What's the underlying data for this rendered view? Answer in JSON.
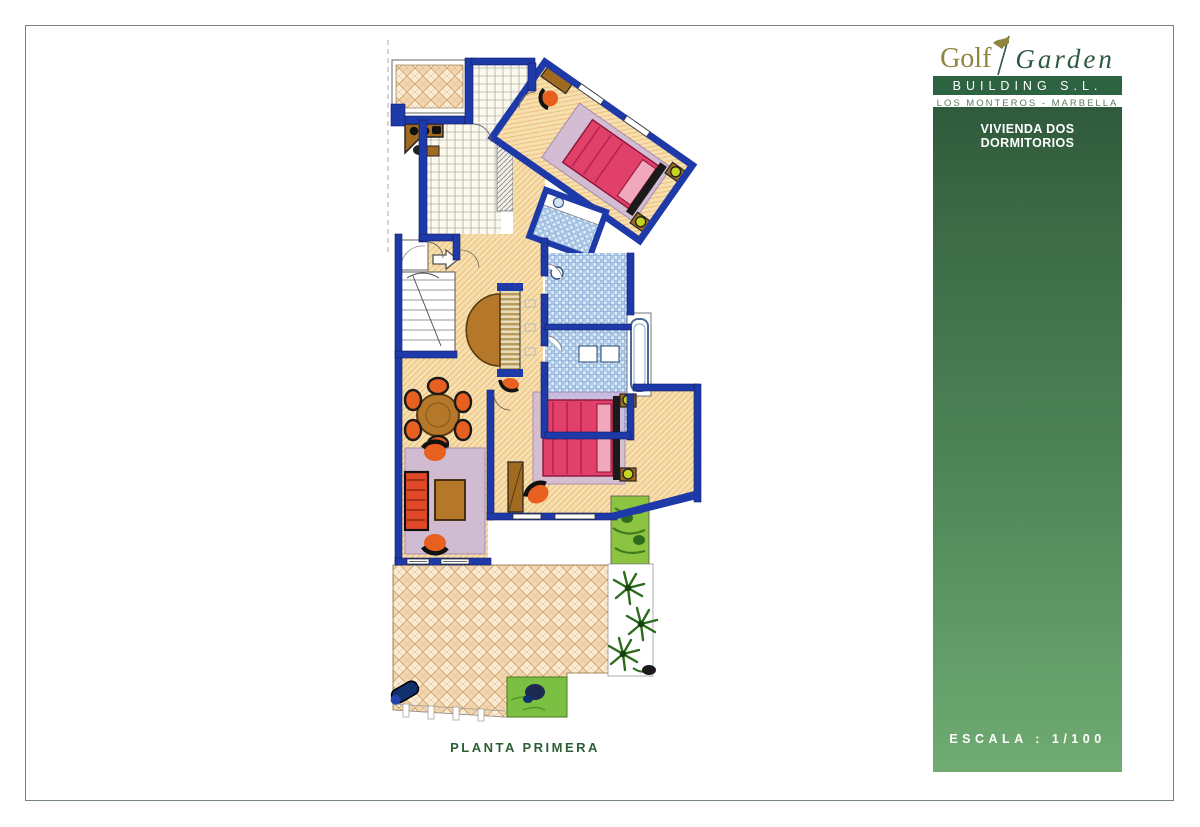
{
  "page": {
    "title": "Golf Garden Building S.L. - Vivienda Dos Dormitorios"
  },
  "brand": {
    "logo_word1": "Golf",
    "logo_word2": "Garden",
    "tagline_bar": "BUILDING S.L.",
    "location": "LOS MONTEROS - MARBELLA"
  },
  "panel": {
    "heading": "VIVIENDA DOS DORMITORIOS",
    "scale": "ESCALA : 1/100"
  },
  "plan": {
    "caption": "PLANTA PRIMERA",
    "floor_name": "Planta Primera",
    "rooms": [
      "terraza superior",
      "cocina",
      "dormitorio 1",
      "banos",
      "vestibulo",
      "escalera",
      "comedor",
      "salon",
      "dormitorio 2",
      "terraza inferior",
      "jardin"
    ]
  },
  "colors": {
    "panel_green_top": "#2f5a3c",
    "panel_green_bottom": "#6fab72",
    "brand_bar_green": "#2e6341",
    "logo_gold": "#8f8440",
    "logo_green": "#2c5a40",
    "caption_green": "#2d5f35",
    "wall_blue": "#1e3aa8",
    "floor_cream": "#f7e0b0",
    "tile_blue": "#aac8e8",
    "bed_red": "#e0406a",
    "sofa_red": "#e04828",
    "chair_orange": "#e8601f",
    "rug_purple": "#cbb7da",
    "garden_green": "#7cc043"
  }
}
